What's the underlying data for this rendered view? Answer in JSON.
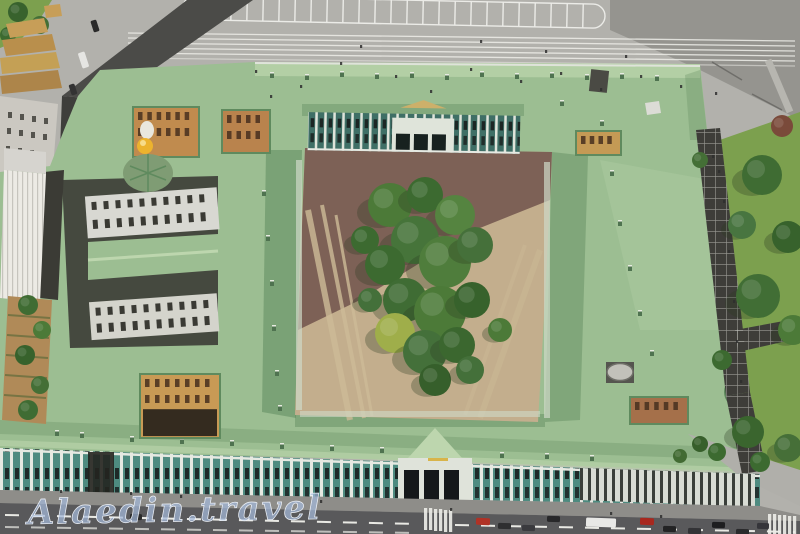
{
  "scene": {
    "type": "aerial-photograph",
    "watermark": "Alaedin.travel"
  },
  "palette": {
    "pavement": "#b2b1ac",
    "road_dark": "#4b4b48",
    "road_mid": "#95948f",
    "street": "#59595b",
    "sidewalk": "#8e8d89",
    "roof_green": "#9cbe92",
    "roof_green_dark": "#5f8a5e",
    "roof_highlight": "#bdd6ae",
    "facade_teal": "#4e8b80",
    "facade_white": "#e6e9e2",
    "courtyard_tan": "#c3ae8d",
    "courtyard_brown": "#7d6156",
    "lawn": "#7ca04e",
    "tree": "#46712f",
    "tree_dark": "#35602a",
    "ochre": "#c79e58",
    "grey_building": "#cbc8c1",
    "ribbed_white": "#eceae4",
    "gold": "#ecb32e",
    "dome_green": "#7f9c74",
    "dome_grey": "#c2c1ba",
    "walkway": "#3e3d39",
    "watermark_blue": "#a4b8da",
    "stripe_white": "#f2f2ee"
  },
  "scene_items": {
    "trees_courtyard": [
      [
        390,
        205,
        22,
        "#4c7a38"
      ],
      [
        425,
        195,
        18,
        "#3c6a30"
      ],
      [
        455,
        215,
        20,
        "#558440"
      ],
      [
        415,
        240,
        24,
        "#46743a"
      ],
      [
        385,
        265,
        20,
        "#3c6a30"
      ],
      [
        445,
        262,
        26,
        "#4f7d3c"
      ],
      [
        475,
        245,
        18,
        "#45703a"
      ],
      [
        405,
        300,
        22,
        "#3f6c34"
      ],
      [
        440,
        312,
        26,
        "#4c7a38"
      ],
      [
        472,
        300,
        18,
        "#37622c"
      ],
      [
        395,
        333,
        20,
        "#9fae4a"
      ],
      [
        425,
        352,
        22,
        "#44703a"
      ],
      [
        457,
        345,
        18,
        "#3b672f"
      ],
      [
        435,
        380,
        16,
        "#365f2b"
      ],
      [
        470,
        370,
        14,
        "#44703a"
      ],
      [
        500,
        330,
        12,
        "#4c7a38"
      ],
      [
        365,
        240,
        14,
        "#3c6a30"
      ],
      [
        370,
        300,
        12,
        "#44703a"
      ]
    ],
    "trees_park": [
      [
        762,
        175,
        20,
        "#3f6c33"
      ],
      [
        742,
        225,
        14,
        "#487540"
      ],
      [
        788,
        237,
        16,
        "#37622c"
      ],
      [
        758,
        296,
        22,
        "#416e35"
      ],
      [
        793,
        330,
        15,
        "#4c7a38"
      ],
      [
        722,
        360,
        10,
        "#3c6a30"
      ],
      [
        748,
        432,
        16,
        "#3a652e"
      ],
      [
        788,
        448,
        14,
        "#466f38"
      ],
      [
        717,
        452,
        9,
        "#3c6a30"
      ],
      [
        700,
        160,
        8,
        "#446f36"
      ],
      [
        782,
        126,
        11,
        "#7a4a3a"
      ],
      [
        700,
        444,
        8,
        "#375f2b"
      ],
      [
        680,
        456,
        7,
        "#426b33"
      ],
      [
        760,
        462,
        10,
        "#3c6a30"
      ]
    ],
    "trees_garden": [
      [
        28,
        305,
        10,
        "#3f6c33"
      ],
      [
        42,
        330,
        9,
        "#4c7a38"
      ],
      [
        25,
        355,
        10,
        "#37622c"
      ],
      [
        40,
        385,
        9,
        "#446f36"
      ],
      [
        28,
        410,
        10,
        "#3f6c33"
      ]
    ],
    "trees_corner": [
      [
        18,
        12,
        10,
        "#38622d"
      ],
      [
        40,
        25,
        9,
        "#446f36"
      ],
      [
        8,
        35,
        8,
        "#3c6a30"
      ]
    ],
    "cars": [
      {
        "x": 476,
        "y": 518,
        "w": 14,
        "h": 7,
        "c": "#b03226",
        "r": 2
      },
      {
        "x": 498,
        "y": 523,
        "w": 13,
        "h": 6,
        "c": "#2e2e30",
        "r": 2
      },
      {
        "x": 522,
        "y": 525,
        "w": 13,
        "h": 6,
        "c": "#3a3a3e",
        "r": 2
      },
      {
        "x": 547,
        "y": 516,
        "w": 13,
        "h": 6,
        "c": "#28282a",
        "r": 2
      },
      {
        "x": 586,
        "y": 518,
        "w": 30,
        "h": 9,
        "c": "#e8e8e6",
        "r": 2
      },
      {
        "x": 640,
        "y": 518,
        "w": 14,
        "h": 7,
        "c": "#a8281e",
        "r": 2
      },
      {
        "x": 663,
        "y": 526,
        "w": 13,
        "h": 6,
        "c": "#232324",
        "r": 2
      },
      {
        "x": 688,
        "y": 528,
        "w": 13,
        "h": 6,
        "c": "#333336",
        "r": 2
      },
      {
        "x": 712,
        "y": 522,
        "w": 13,
        "h": 6,
        "c": "#1e1e20",
        "r": 2
      },
      {
        "x": 736,
        "y": 529,
        "w": 13,
        "h": 6,
        "c": "#2a2a2c",
        "r": 2
      },
      {
        "x": 757,
        "y": 523,
        "w": 12,
        "h": 6,
        "c": "#35353a",
        "r": 2
      },
      {
        "x": 130,
        "y": 514,
        "w": 12,
        "h": 6,
        "c": "#2a2a2a",
        "r": 1
      },
      {
        "x": 80,
        "y": 52,
        "w": 7,
        "h": 16,
        "c": "#e5e5e2",
        "r": -18
      },
      {
        "x": 92,
        "y": 20,
        "w": 6,
        "h": 12,
        "c": "#2a2a2a",
        "r": -18
      },
      {
        "x": 70,
        "y": 84,
        "w": 6,
        "h": 11,
        "c": "#333333",
        "r": -18
      }
    ],
    "people": [
      [
        255,
        70
      ],
      [
        300,
        85
      ],
      [
        340,
        62
      ],
      [
        395,
        75
      ],
      [
        430,
        90
      ],
      [
        470,
        68
      ],
      [
        520,
        80
      ],
      [
        560,
        72
      ],
      [
        600,
        88
      ],
      [
        640,
        75
      ],
      [
        545,
        50
      ],
      [
        480,
        40
      ],
      [
        360,
        45
      ],
      [
        680,
        85
      ],
      [
        715,
        92
      ],
      [
        270,
        95
      ],
      [
        625,
        55
      ],
      [
        718,
        170
      ],
      [
        723,
        200
      ],
      [
        728,
        250
      ],
      [
        733,
        300
      ],
      [
        736,
        340
      ],
      [
        740,
        380
      ],
      [
        180,
        495
      ],
      [
        320,
        500
      ],
      [
        450,
        508
      ],
      [
        610,
        512
      ],
      [
        660,
        515
      ],
      [
        130,
        492
      ],
      [
        60,
        490
      ],
      [
        712,
        155
      ]
    ],
    "lightwells": [
      {
        "x": 133,
        "y": 107,
        "w": 66,
        "h": 50,
        "wall": "#c08b4e",
        "rows": 2,
        "darkBottom": false
      },
      {
        "x": 222,
        "y": 110,
        "w": 48,
        "h": 43,
        "wall": "#b9834d",
        "rows": 2,
        "darkBottom": false
      },
      {
        "x": 576,
        "y": 131,
        "w": 45,
        "h": 24,
        "wall": "#c49a55",
        "rows": 1,
        "darkBottom": false
      },
      {
        "x": 140,
        "y": 374,
        "w": 80,
        "h": 64,
        "wall": "#c89a55",
        "rows": 2,
        "darkBottom": true
      },
      {
        "x": 630,
        "y": 397,
        "w": 58,
        "h": 27,
        "wall": "#a5704a",
        "rows": 1,
        "darkBottom": false
      }
    ],
    "chimneys": [
      [
        270,
        72
      ],
      [
        305,
        74
      ],
      [
        340,
        71
      ],
      [
        375,
        73
      ],
      [
        410,
        72
      ],
      [
        445,
        74
      ],
      [
        480,
        71
      ],
      [
        515,
        73
      ],
      [
        550,
        72
      ],
      [
        585,
        74
      ],
      [
        620,
        73
      ],
      [
        655,
        75
      ],
      [
        262,
        190
      ],
      [
        266,
        235
      ],
      [
        270,
        280
      ],
      [
        272,
        325
      ],
      [
        275,
        370
      ],
      [
        278,
        405
      ],
      [
        80,
        432
      ],
      [
        130,
        436
      ],
      [
        180,
        438
      ],
      [
        230,
        440
      ],
      [
        280,
        443
      ],
      [
        330,
        445
      ],
      [
        380,
        447
      ],
      [
        500,
        452
      ],
      [
        545,
        453
      ],
      [
        590,
        455
      ],
      [
        55,
        430
      ],
      [
        600,
        120
      ],
      [
        610,
        170
      ],
      [
        618,
        220
      ],
      [
        628,
        265
      ],
      [
        638,
        310
      ],
      [
        650,
        350
      ],
      [
        560,
        100
      ]
    ]
  }
}
